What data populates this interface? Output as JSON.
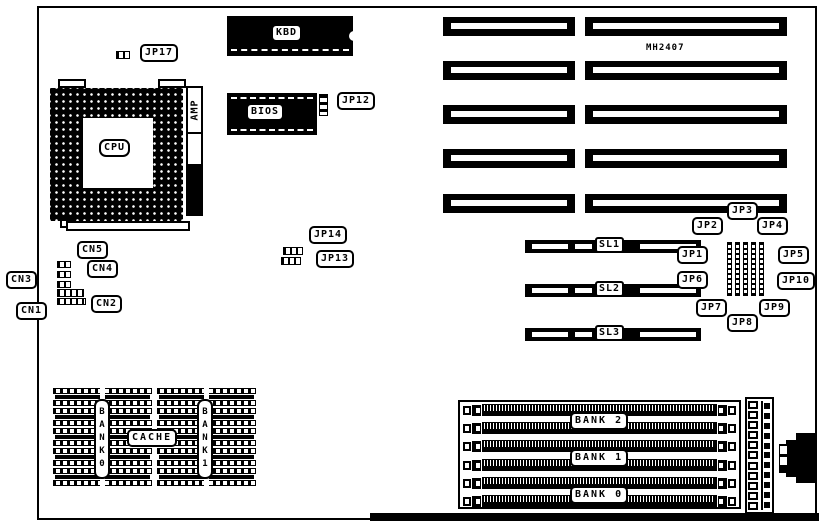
{
  "board_ref": "MH2407",
  "chips": {
    "cpu": "CPU",
    "kbd": "KBD",
    "bios": "BIOS",
    "amp": "AMP"
  },
  "jumpers": {
    "jp1": "JP1",
    "jp2": "JP2",
    "jp3": "JP3",
    "jp4": "JP4",
    "jp5": "JP5",
    "jp6": "JP6",
    "jp7": "JP7",
    "jp8": "JP8",
    "jp9": "JP9",
    "jp10": "JP10",
    "jp12": "JP12",
    "jp13": "JP13",
    "jp14": "JP14",
    "jp17": "JP17"
  },
  "connectors": {
    "cn1": "CN1",
    "cn2": "CN2",
    "cn3": "CN3",
    "cn4": "CN4",
    "cn5": "CN5"
  },
  "slots": {
    "sl1": "SL1",
    "sl2": "SL2",
    "sl3": "SL3"
  },
  "cache": {
    "label": "CACHE",
    "bank0": "BANK0",
    "bank1": "BANK1"
  },
  "memory_banks": {
    "bank0": "BANK 0",
    "bank1": "BANK 1",
    "bank2": "BANK 2"
  }
}
